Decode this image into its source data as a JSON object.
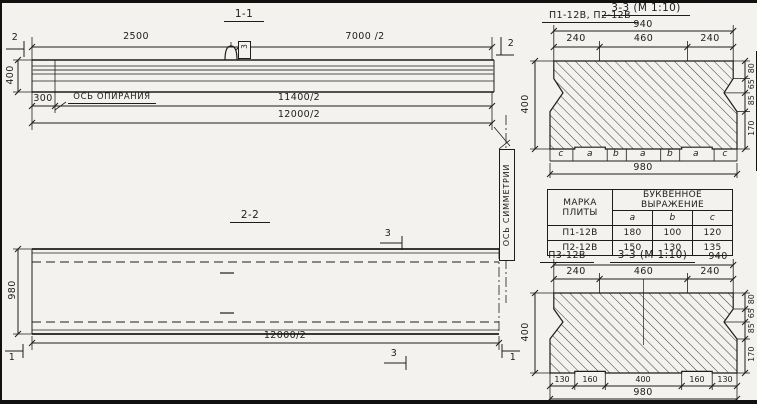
{
  "view1": {
    "title": "1-1",
    "dim_2500": "2500",
    "dim_7000": "7000 /2",
    "dim_400": "400",
    "dim_300": "300",
    "dim_11400": "11400/2",
    "dim_12000": "12000/2",
    "axis_label": "ОСЬ ОПИРАНИЯ",
    "loop_tag": "3",
    "section_marker": "2"
  },
  "view2": {
    "title": "2-2",
    "dim_980": "980",
    "dim_12000": "12000/2",
    "marker_3": "3",
    "marker_1": "1",
    "symmetry_label": "ОСЬ СИММЕТРИИ"
  },
  "section_a": {
    "label": "П1-12В, П2-12В",
    "title": "3-3 (М 1:10)",
    "top_width": "940",
    "splits": [
      "240",
      "460",
      "240"
    ],
    "letters": [
      "c",
      "a",
      "b",
      "a",
      "b",
      "a",
      "c"
    ],
    "bottom_width": "980",
    "height": "400",
    "right_dims": [
      "80",
      "65",
      "85",
      "170"
    ]
  },
  "table": {
    "col1_line1": "МАРКА",
    "col1_line2": "ПЛИТЫ",
    "header_span": "БУКВЕННОЕ ВЫРАЖЕНИЕ",
    "subcols": [
      "a",
      "b",
      "c"
    ],
    "rows": [
      {
        "mark": "П1-12В",
        "a": "180",
        "b": "100",
        "c": "120"
      },
      {
        "mark": "П2-12В",
        "a": "150",
        "b": "130",
        "c": "135"
      }
    ]
  },
  "section_b": {
    "label": "П3-12В",
    "title": "3-3 (М 1:10)",
    "top_width": "940",
    "splits": [
      "240",
      "460",
      "240"
    ],
    "bottom_splits": [
      "130",
      "160",
      "400",
      "160",
      "130"
    ],
    "bottom_width": "980",
    "height": "400",
    "right_dims": [
      "80",
      "65",
      "85",
      "170"
    ]
  }
}
